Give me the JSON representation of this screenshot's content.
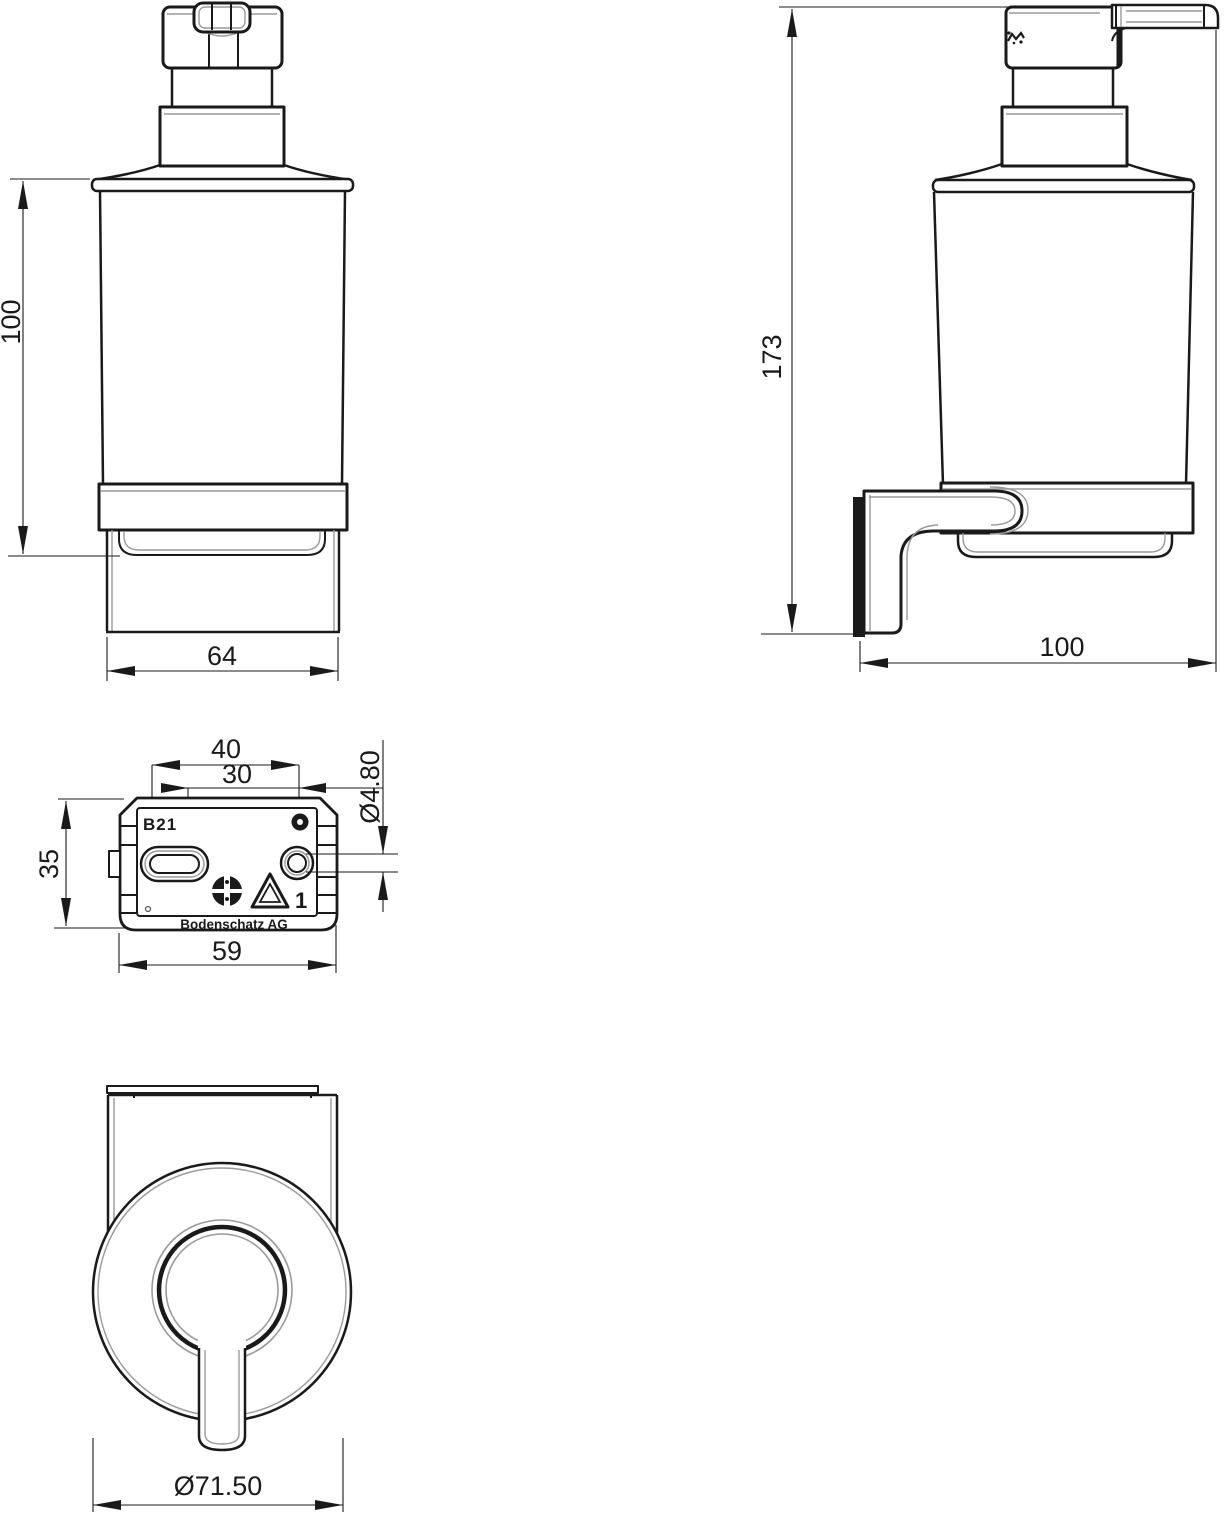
{
  "drawing": {
    "description": "Technical dimension drawing of a wall-mounted glass soap dispenser with mounting bracket",
    "colors": {
      "line": "#1a1a1a",
      "detail": "#9a9a9a",
      "background": "#ffffff"
    },
    "views": {
      "front": {
        "dim_height": "100",
        "dim_width": "64"
      },
      "side": {
        "dim_height": "173",
        "dim_depth": "100"
      },
      "bracket": {
        "label_model": "B21",
        "label_material_class": "1",
        "label_brand": "Bodenschatz AG",
        "dim_hole_spacing": "40",
        "dim_slot_spacing": "30",
        "dim_hole_diameter": "Ø4.80",
        "dim_height": "35",
        "dim_width": "59"
      },
      "bottom": {
        "dim_diameter": "Ø71.50"
      }
    }
  }
}
